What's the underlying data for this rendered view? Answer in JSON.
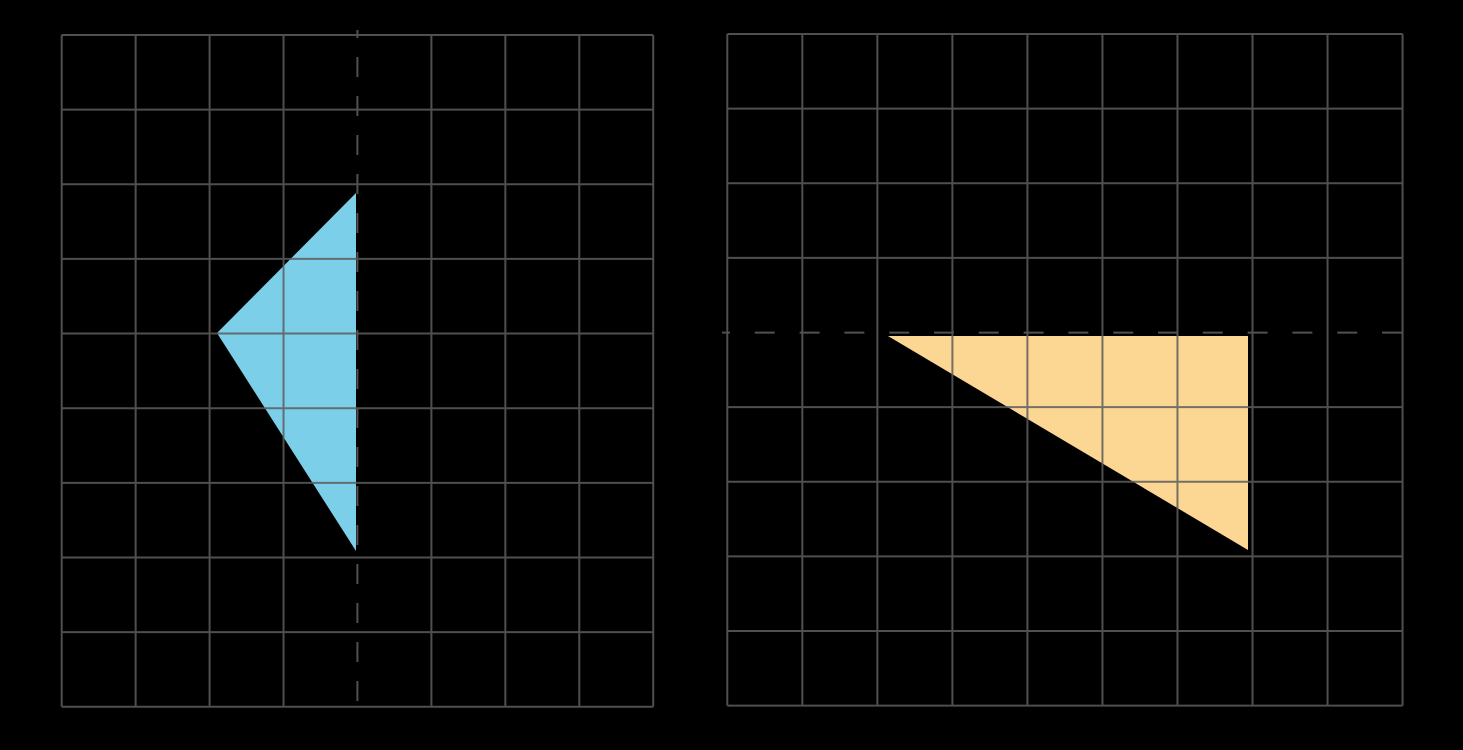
{
  "figure": {
    "background_color": "#000000",
    "grid_color": "#5d5d5d",
    "grid_opacity": 0.85,
    "grid_stroke_width": 2,
    "dashed_line_color": "#515151",
    "panels": [
      {
        "name": "left",
        "grid": {
          "x": 61.7,
          "y": 35,
          "cols": 8,
          "rows": 9,
          "cell_w": 73.94,
          "cell_h": 74.64,
          "skip_col": 4,
          "skip_row": null
        },
        "shape": {
          "name": "blue-triangle",
          "fill": "#7ccfe8",
          "vertices_px": [
            [
              356,
              193
            ],
            [
              217,
              333
            ],
            [
              356,
              551
            ]
          ],
          "vertices_grid_units": [
            [
              4,
              2
            ],
            [
              2,
              4
            ],
            [
              4,
              7
            ]
          ]
        },
        "reflection_line": {
          "orientation": "vertical",
          "position": 357.4,
          "from": 30,
          "to": 711,
          "dash_array": "20 19",
          "dash_offset": 12
        }
      },
      {
        "name": "right",
        "grid": {
          "x": 727.3,
          "y": 34,
          "cols": 9,
          "rows": 9,
          "cell_w": 75.03,
          "cell_h": 74.63,
          "skip_col": null,
          "skip_row": 4
        },
        "shape": {
          "name": "orange-triangle",
          "fill": "#fcd794",
          "vertices_px": [
            [
              888,
              336
            ],
            [
              1248,
              336
            ],
            [
              1248,
              550
            ]
          ],
          "vertices_grid_units": [
            [
              2,
              4
            ],
            [
              7,
              4
            ],
            [
              7,
              7
            ]
          ]
        },
        "reflection_line": {
          "orientation": "horizontal",
          "position": 332.6,
          "from": 722,
          "to": 1412,
          "dash_array": "20 24.8",
          "dash_offset": 12
        }
      }
    ]
  }
}
